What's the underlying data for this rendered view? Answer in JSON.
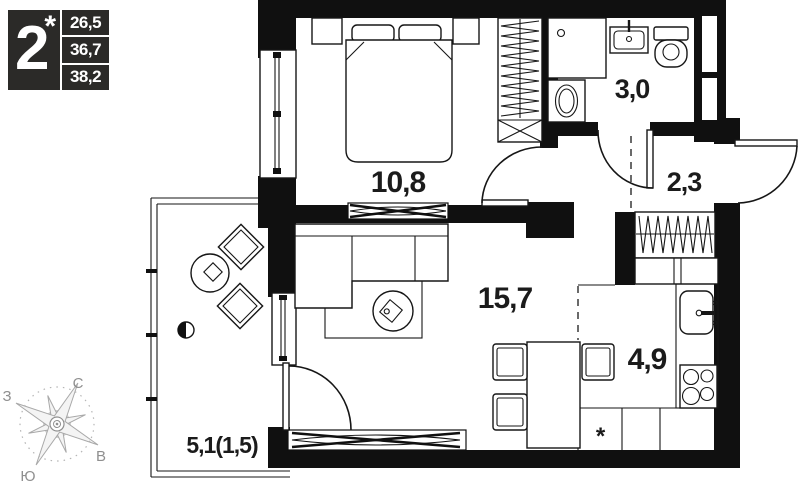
{
  "badge": {
    "rooms_count": "2",
    "star": "*",
    "areas": [
      "26,5",
      "36,7",
      "38,2"
    ]
  },
  "rooms": {
    "bedroom": {
      "label": "10,8"
    },
    "bathroom": {
      "label": "3,0"
    },
    "hallway": {
      "label": "2,3"
    },
    "living": {
      "label": "15,7"
    },
    "kitchen": {
      "label": "4,9"
    },
    "balcony": {
      "label": "5,1(1,5)"
    }
  },
  "symbols": {
    "fridge_mark": "*"
  },
  "compass": {
    "north": "С",
    "south": "Ю",
    "west": "З",
    "east": "В"
  },
  "colors": {
    "wall": "#101010",
    "label": "#1b1b1b",
    "badge_bg": "#2b2a28",
    "compass_gray": "#a8a8a8"
  }
}
